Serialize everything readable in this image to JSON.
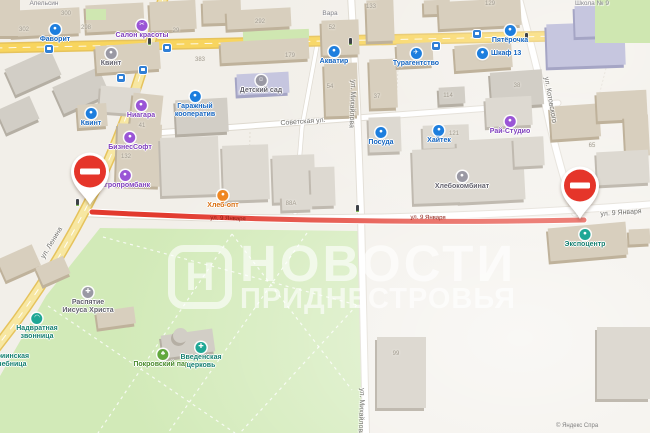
{
  "watermark": {
    "logo_letter": "Н",
    "title_line1": "НОВОСТИ",
    "title_line2": "ПРИДНЕСТРОВЬЯ"
  },
  "attribution": {
    "text": "© Яндекс   Спра"
  },
  "colors": {
    "closure_red": "#e23a2e",
    "road_yellow": "#f8d55e",
    "road_yellow_pale": "#f7e7a2",
    "park_green": "#d2eab8",
    "poi_blue": "#1d7ede",
    "poi_purple": "#9a55d6",
    "poi_orange": "#ef8722",
    "poi_teal": "#1fa795",
    "poi_green": "#62a83e",
    "pin_red": "#e5352a"
  },
  "no_entry_pins": [
    {
      "x": 90,
      "y": 205
    },
    {
      "x": 580,
      "y": 219
    }
  ],
  "streets": [
    {
      "name": "Советская ул.",
      "x": 303,
      "y": 122,
      "rot": -4,
      "variant": "normal"
    },
    {
      "name": "ул. Михайлова",
      "x": 352,
      "y": 104,
      "rot": 92,
      "variant": "normal"
    },
    {
      "name": "ул. Михайлова",
      "x": 361,
      "y": 412,
      "rot": 92,
      "variant": "normal"
    },
    {
      "name": "ул. Котовского",
      "x": 550,
      "y": 100,
      "rot": 80,
      "variant": "normal"
    },
    {
      "name": "ул. Ленина",
      "x": 52,
      "y": 243,
      "rot": -59,
      "variant": "normal"
    },
    {
      "name": "ул. 9 Января",
      "x": 621,
      "y": 213,
      "rot": -4,
      "variant": "normal"
    },
    {
      "name": "ул. 9 Января",
      "x": 228,
      "y": 219,
      "rot": 2,
      "variant": "closed"
    },
    {
      "name": "ул. 9 Января",
      "x": 428,
      "y": 218,
      "rot": 1,
      "variant": "closed"
    }
  ],
  "pois": [
    {
      "label": "Фаворит",
      "x": 55,
      "y": 24,
      "color": "blue",
      "icon": "store-icon"
    },
    {
      "label": "Салон красоты",
      "x": 142,
      "y": 20,
      "color": "purple",
      "icon": "scissors-icon"
    },
    {
      "label": "Квинт",
      "x": 111,
      "y": 48,
      "color": "gray",
      "icon": "factory-icon"
    },
    {
      "label": "Квинт",
      "x": 91,
      "y": 108,
      "color": "blue",
      "icon": "store-icon"
    },
    {
      "label": "Ниагара",
      "x": 141,
      "y": 100,
      "color": "purple",
      "icon": "store-icon"
    },
    {
      "lines": [
        "Гаражный",
        "кооператив"
      ],
      "x": 195,
      "y": 91,
      "color": "blue",
      "icon": "garage-icon"
    },
    {
      "label": "БизнесСофт",
      "x": 130,
      "y": 132,
      "color": "purple",
      "icon": "office-icon"
    },
    {
      "label": "Агропромбанк",
      "x": 125,
      "y": 170,
      "color": "purple",
      "icon": "bank-icon"
    },
    {
      "label": "Хлеб-опт",
      "x": 223,
      "y": 190,
      "color": "orange",
      "icon": "bakery-icon"
    },
    {
      "label": "Акватир",
      "x": 334,
      "y": 46,
      "color": "blue",
      "icon": "office-icon"
    },
    {
      "label": "Детский сад",
      "x": 261,
      "y": 75,
      "color": "gray",
      "icon": "smiley-icon"
    },
    {
      "label": "Посуда",
      "x": 381,
      "y": 127,
      "color": "blue",
      "icon": "store-icon"
    },
    {
      "label": "Хайтек",
      "x": 439,
      "y": 125,
      "color": "blue",
      "icon": "cart-icon"
    },
    {
      "label": "Хлебокомбинат",
      "x": 462,
      "y": 171,
      "color": "gray",
      "icon": "factory-icon"
    },
    {
      "label": "Турагентство",
      "x": 416,
      "y": 48,
      "color": "blue",
      "icon": "airplane-icon"
    },
    {
      "label": "Пятёрочка",
      "x": 510,
      "y": 25,
      "color": "blue",
      "icon": "grocery-icon"
    },
    {
      "label": "Шкаф 13",
      "x": 483,
      "y": 48,
      "color": "blue",
      "icon": "furniture-icon",
      "side": "right"
    },
    {
      "label": "Рай-Студио",
      "x": 510,
      "y": 116,
      "color": "purple",
      "icon": "studio-icon"
    },
    {
      "label": "Экспоцентр",
      "x": 585,
      "y": 229,
      "color": "teal",
      "icon": "expo-icon"
    },
    {
      "lines": [
        "Распятие",
        "Иисуса Христа"
      ],
      "x": 88,
      "y": 287,
      "color": "gray",
      "icon": "cross-icon"
    },
    {
      "lines": [
        "Надвратная",
        "звонница"
      ],
      "x": 37,
      "y": 313,
      "color": "teal",
      "icon": "bell-icon"
    },
    {
      "label": "Покровский парк",
      "x": 163,
      "y": 349,
      "color": "green",
      "icon": "tree-icon"
    },
    {
      "lines": [
        "Введенская",
        "церковь"
      ],
      "x": 201,
      "y": 342,
      "color": "teal",
      "icon": "church-cross-icon"
    },
    {
      "lines": [
        "Мариинская",
        "лечебница"
      ],
      "x": 8,
      "y": 352,
      "color": "teal"
    }
  ],
  "labels": [
    {
      "text": "Апельсин",
      "x": 44,
      "y": 0
    },
    {
      "text": "Вара",
      "x": 330,
      "y": 10
    },
    {
      "text": "Школа № 9",
      "x": 592,
      "y": 0
    }
  ],
  "numbers": [
    {
      "n": "302",
      "x": 24,
      "y": 30
    },
    {
      "n": "300",
      "x": 66,
      "y": 14
    },
    {
      "n": "298",
      "x": 86,
      "y": 28
    },
    {
      "n": "29",
      "x": 176,
      "y": 31
    },
    {
      "n": "383",
      "x": 200,
      "y": 60
    },
    {
      "n": "41",
      "x": 142,
      "y": 126
    },
    {
      "n": "132",
      "x": 126,
      "y": 157
    },
    {
      "n": "292",
      "x": 260,
      "y": 22
    },
    {
      "n": "179",
      "x": 290,
      "y": 56
    },
    {
      "n": "52",
      "x": 332,
      "y": 28
    },
    {
      "n": "54",
      "x": 330,
      "y": 87
    },
    {
      "n": "133",
      "x": 371,
      "y": 7
    },
    {
      "n": "37",
      "x": 377,
      "y": 97
    },
    {
      "n": "88А",
      "x": 291,
      "y": 204
    },
    {
      "n": "129",
      "x": 490,
      "y": 4
    },
    {
      "n": "38",
      "x": 517,
      "y": 86
    },
    {
      "n": "114",
      "x": 448,
      "y": 96
    },
    {
      "n": "121",
      "x": 454,
      "y": 134
    },
    {
      "n": "65",
      "x": 592,
      "y": 146
    },
    {
      "n": "99",
      "x": 396,
      "y": 354
    }
  ],
  "transit": {
    "traffic_lights": [
      {
        "x": 149,
        "y": 41
      },
      {
        "x": 350,
        "y": 41
      },
      {
        "x": 526,
        "y": 36
      },
      {
        "x": 77,
        "y": 202
      },
      {
        "x": 357,
        "y": 208
      }
    ],
    "bus_stops": [
      {
        "x": 49,
        "y": 49
      },
      {
        "x": 167,
        "y": 48
      },
      {
        "x": 143,
        "y": 70
      },
      {
        "x": 121,
        "y": 78
      },
      {
        "x": 436,
        "y": 46
      },
      {
        "x": 477,
        "y": 34
      }
    ]
  }
}
